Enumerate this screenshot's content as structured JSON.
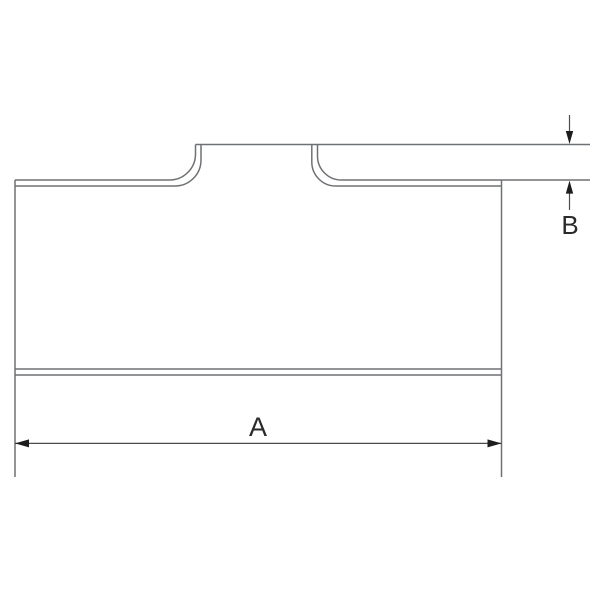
{
  "drawing": {
    "labels": {
      "dim_a": "A",
      "dim_b": "B"
    },
    "colors": {
      "background": "#ffffff",
      "outline": "#6e7174",
      "dimension_line": "#4a4c4e",
      "arrow": "#1d1d1d",
      "label_text": "#2a2a2a"
    }
  }
}
